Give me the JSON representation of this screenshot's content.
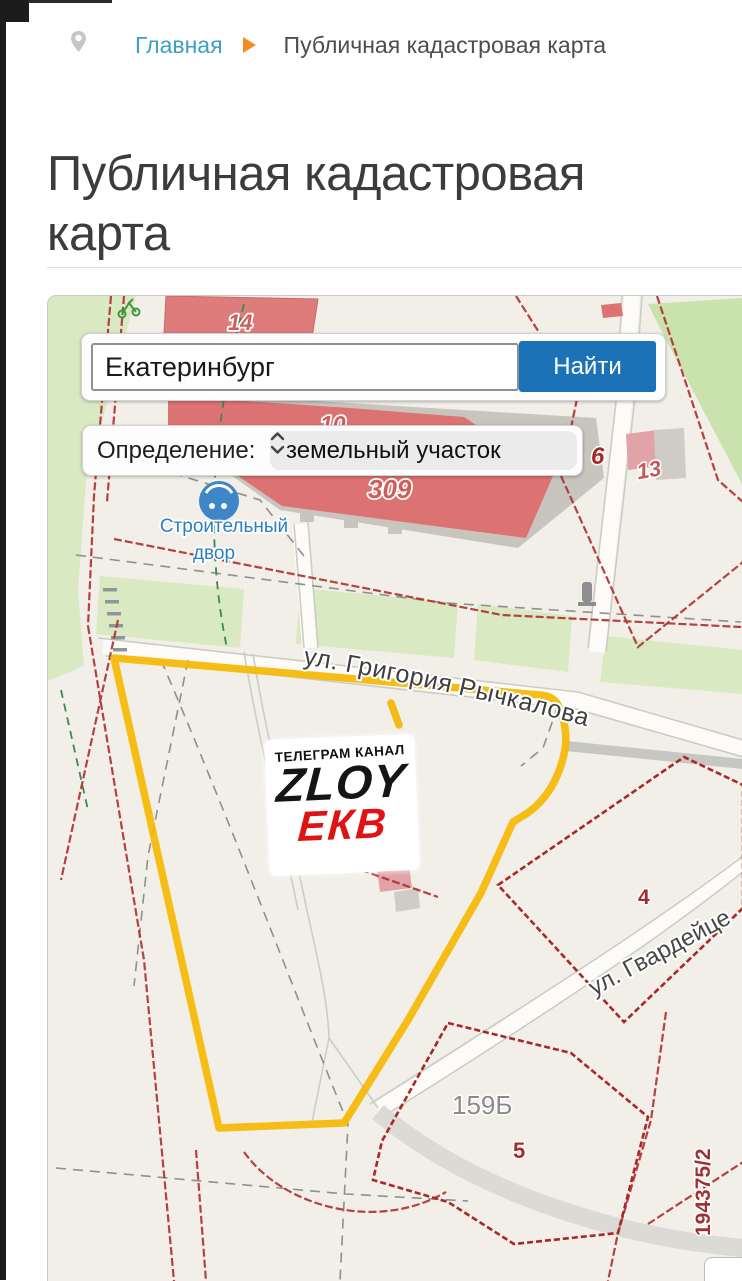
{
  "breadcrumb": {
    "home": "Главная",
    "current": "Публичная кадастровая карта"
  },
  "page": {
    "title": "Публичная кадастровая карта"
  },
  "search": {
    "value": "Екатеринбург",
    "button": "Найти"
  },
  "filter": {
    "label": "Определение:",
    "selected": "земельный участок"
  },
  "map": {
    "poi_line1": "Строительный",
    "poi_line2": "двор",
    "street1": "ул. Григория Рычкалова",
    "street2": "ул. Гвардейце",
    "cadastral_number": "194375/2",
    "parcel_labels": {
      "p14": "14",
      "p10": "10",
      "p309": "309",
      "p6": "6",
      "p13": "13",
      "p4": "4",
      "p5": "5",
      "p159": "159Б"
    }
  },
  "watermark": {
    "line1": "ТЕЛЕГРАМ КАНАЛ",
    "line2": "ZLOY",
    "line3": "ЕКВ"
  },
  "colors": {
    "accent_blue": "#1c72b7",
    "link_teal": "#3aa0c4",
    "arrow_orange": "#ee8f20",
    "highlight_yellow": "#f4b90a",
    "cadastral_red": "#b13232"
  }
}
